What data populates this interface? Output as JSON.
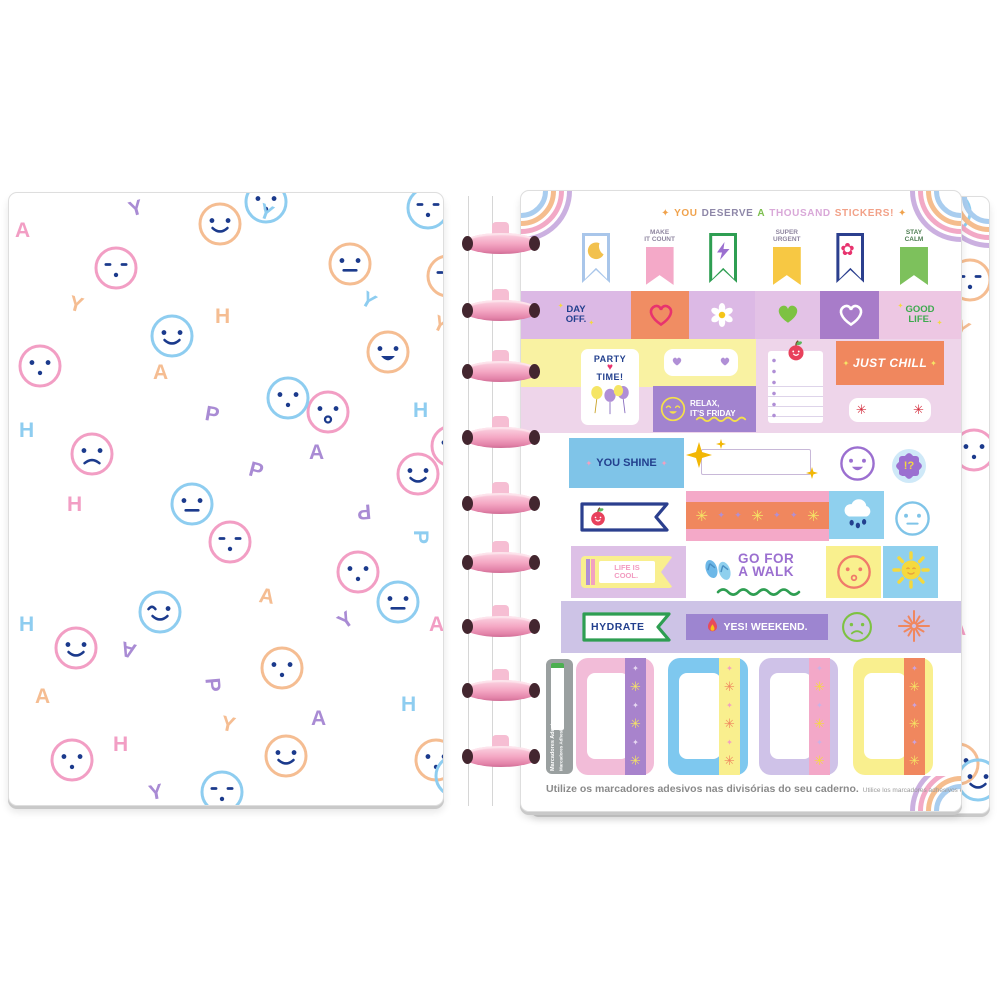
{
  "header": {
    "parts": [
      {
        "t": "✦",
        "c": "#f0a24c"
      },
      {
        "t": "YOU",
        "c": "#f0a24c"
      },
      {
        "t": "DESERVE",
        "c": "#8e87a8"
      },
      {
        "t": "A",
        "c": "#7cbf4e"
      },
      {
        "t": "THOUSAND",
        "c": "#d9a8d8"
      },
      {
        "t": "STICKERS!",
        "c": "#f2a188"
      },
      {
        "t": "✦",
        "c": "#f0a24c"
      }
    ]
  },
  "flags": [
    {
      "type": "outline",
      "color": "#a9c6ea",
      "icon": "moon-icon",
      "label": "",
      "labelColor": ""
    },
    {
      "type": "solid",
      "color": "#f4a9c8",
      "icon": "",
      "label": "MAKE\nIT COUNT",
      "labelColor": "#8f86a0"
    },
    {
      "type": "outline",
      "color": "#2e9e52",
      "icon": "lightning-icon",
      "label": "",
      "labelColor": ""
    },
    {
      "type": "solid",
      "color": "#f7c843",
      "icon": "",
      "label": "SUPER\nURGENT",
      "labelColor": "#8f86a0"
    },
    {
      "type": "outline",
      "color": "#2b3f8e",
      "icon": "flower-icon",
      "label": "",
      "labelColor": ""
    },
    {
      "type": "solid",
      "color": "#7dc15c",
      "icon": "",
      "label": "STAY\nCALM",
      "labelColor": "#4e7d52"
    }
  ],
  "row2": [
    {
      "w": 110,
      "bg": "#dcb9e5",
      "text": "DAY\nOFF.",
      "textColor": "#23408e"
    },
    {
      "w": 58,
      "bg": "#f08d63",
      "icon": "heart-outline-icon",
      "iconColor": "#e8336e"
    },
    {
      "w": 66,
      "bg": "#dcb9e5",
      "icon": "daisy-icon",
      "iconColor": ""
    },
    {
      "w": 65,
      "bg": "#e3c2e6",
      "icon": "heart-icon",
      "iconColor": "#7dc242"
    },
    {
      "w": 59,
      "bg": "#a87cc9",
      "icon": "heart-outline-icon",
      "iconColor": "#ffffff"
    },
    {
      "w": 82,
      "bg": "#edc7e3",
      "text": "GOOD\nLIFE.",
      "textColor": "#3daa4e"
    }
  ],
  "stickers": {
    "party_line1": "PARTY",
    "party_line2": "TIME!",
    "party_heart": "♥",
    "relax": "RELAX,\nIT'S FRIDAY",
    "just_chill": "JUST CHILL",
    "you_shine": "YOU SHINE",
    "life_cool": "LIFE IS\nCOOL.",
    "go_walk": "GO FOR\nA WALK",
    "hydrate": "HYDRATE",
    "yes_weekend": "YES! WEEKEND.",
    "interrobang": "!?"
  },
  "washi": {
    "sequence": [
      [
        "✳",
        "y"
      ],
      [
        "✦",
        "p"
      ],
      [
        "✦",
        "p"
      ],
      [
        "✳",
        "y"
      ],
      [
        "✦",
        "p"
      ],
      [
        "✦",
        "p"
      ],
      [
        "✳",
        "y"
      ]
    ],
    "colors": {
      "y": "#f5e565",
      "p": "#b08fd6"
    }
  },
  "tabs": [
    {
      "x": 55,
      "w": 78,
      "body": "#f2bcd8",
      "stripe": "#a883cc",
      "dia": "#e8d9f2",
      "ast": "#f5e565"
    },
    {
      "x": 147,
      "w": 80,
      "body": "#7ec8ef",
      "stripe": "#f9ef8e",
      "dia": "#f2a0c0",
      "ast": "#f0875e"
    },
    {
      "x": 238,
      "w": 79,
      "body": "#cfc2e8",
      "stripe": "#f3a8c8",
      "dia": "#c9b3e6",
      "ast": "#f5d93e"
    },
    {
      "x": 332,
      "w": 80,
      "body": "#f9ef8e",
      "stripe": "#f0875e",
      "dia": "#c9a3e0",
      "ast": "#f5e565"
    }
  ],
  "side_label": {
    "line1": "Marcadores Adesivos",
    "line2": "Marcadores Adhesivos"
  },
  "caption": {
    "pt": "Utilize os marcadores adesivos nas divisórias do seu caderno.",
    "es": "Utilice los marcadores adhesivos en las divisorias de su cuaderno."
  },
  "binding": {
    "disc_count": 9,
    "disc_color": "#f2a6c0",
    "disc_centers_y": [
      243,
      310,
      371,
      437,
      503,
      562,
      626,
      690,
      756
    ]
  },
  "colors": {
    "navy": "#23408e",
    "lilac": "#dcb9e5",
    "orange_block": "#f08d63",
    "purple_block": "#a283cf",
    "yellow_band": "#f9f2a2",
    "blue_block": "#7fc4e8",
    "pink_washi": "#f4a9c8",
    "rain_blue": "#8fd0ee",
    "row7_lilac": "#cdc3e6",
    "rainbow": [
      "#cbb0e0",
      "#f2a9c6",
      "#f5bd8e",
      "#a9cdef"
    ],
    "pattern_face": "#1b3a8c",
    "pattern_rings": {
      "pink": "#f29ec4",
      "orange": "#f5bd92",
      "blue": "#8ecdf0"
    },
    "pattern_letters": {
      "pink": "#f29ec4",
      "purple": "#a98bd4",
      "orange": "#f5bd92",
      "blue": "#8ecdf0"
    }
  },
  "pattern": {
    "circles": [
      [
        188,
        8,
        "orange",
        "smile"
      ],
      [
        234,
        -14,
        "blue",
        "dots"
      ],
      [
        396,
        -8,
        "blue",
        "dash"
      ],
      [
        8,
        150,
        "pink",
        "updots"
      ],
      [
        84,
        52,
        "pink",
        "dash"
      ],
      [
        318,
        48,
        "orange",
        "neutral"
      ],
      [
        140,
        120,
        "blue",
        "smile"
      ],
      [
        356,
        136,
        "orange",
        "open"
      ],
      [
        296,
        196,
        "pink",
        "o"
      ],
      [
        256,
        182,
        "blue",
        "dots"
      ],
      [
        160,
        288,
        "blue",
        "neutral"
      ],
      [
        198,
        326,
        "pink",
        "dash"
      ],
      [
        44,
        432,
        "pink",
        "smile"
      ],
      [
        128,
        396,
        "blue",
        "wink"
      ],
      [
        326,
        356,
        "pink",
        "dots"
      ],
      [
        366,
        386,
        "blue",
        "neutral"
      ],
      [
        250,
        452,
        "orange",
        "dots"
      ],
      [
        40,
        544,
        "pink",
        "updots"
      ],
      [
        254,
        540,
        "orange",
        "smile"
      ],
      [
        404,
        544,
        "orange",
        "dots"
      ],
      [
        190,
        576,
        "blue",
        "dash"
      ],
      [
        60,
        238,
        "pink",
        "frown"
      ],
      [
        386,
        258,
        "pink",
        "smile"
      ],
      [
        420,
        230,
        "pink",
        "dots"
      ],
      [
        424,
        560,
        "blue",
        "smile"
      ],
      [
        416,
        60,
        "orange",
        "dash"
      ]
    ],
    "letters": [
      [
        "Y",
        "purple",
        120,
        4,
        -15
      ],
      [
        "A",
        "pink",
        6,
        26,
        0
      ],
      [
        "H",
        "orange",
        206,
        112,
        0
      ],
      [
        "Y",
        "blue",
        250,
        8,
        20
      ],
      [
        "A",
        "orange",
        144,
        168,
        0
      ],
      [
        "P",
        "purple",
        196,
        210,
        10
      ],
      [
        "Y",
        "blue",
        352,
        96,
        30
      ],
      [
        "H",
        "blue",
        404,
        206,
        0
      ],
      [
        "H",
        "pink",
        58,
        300,
        0
      ],
      [
        "P",
        "purple",
        240,
        266,
        15
      ],
      [
        "A",
        "purple",
        300,
        248,
        0
      ],
      [
        "P",
        "purple",
        348,
        306,
        175
      ],
      [
        "H",
        "blue",
        10,
        420,
        0
      ],
      [
        "A",
        "purple",
        112,
        444,
        195
      ],
      [
        "Y",
        "purple",
        330,
        416,
        -35
      ],
      [
        "A",
        "orange",
        250,
        392,
        8
      ],
      [
        "P",
        "blue",
        404,
        332,
        90
      ],
      [
        "H",
        "pink",
        104,
        540,
        0
      ],
      [
        "Y",
        "orange",
        212,
        520,
        12
      ],
      [
        "A",
        "purple",
        302,
        514,
        0
      ],
      [
        "H",
        "blue",
        392,
        500,
        0
      ],
      [
        "Y",
        "purple",
        140,
        588,
        -10
      ],
      [
        "A",
        "orange",
        26,
        492,
        0
      ],
      [
        "P",
        "purple",
        196,
        480,
        85
      ],
      [
        "Y",
        "orange",
        60,
        100,
        15
      ],
      [
        "H",
        "blue",
        10,
        226,
        0
      ],
      [
        "Y",
        "orange",
        424,
        120,
        25
      ],
      [
        "A",
        "pink",
        420,
        420,
        0
      ]
    ]
  }
}
